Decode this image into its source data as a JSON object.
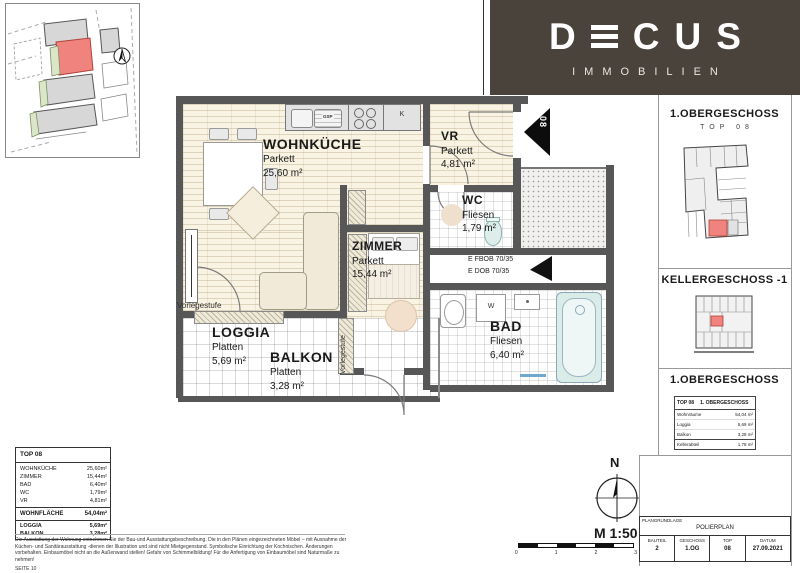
{
  "brand": {
    "name": "DECUS",
    "letters": [
      "D",
      "E",
      "C",
      "U",
      "S"
    ],
    "tagline": "IMMOBILIEN",
    "banner_color": "#49433b"
  },
  "plan": {
    "rooms": [
      {
        "name": "WOHNKÜCHE",
        "floor": "Parkett",
        "area": "25,60 m²"
      },
      {
        "name": "VR",
        "floor": "Parkett",
        "area": "4,81 m²"
      },
      {
        "name": "WC",
        "floor": "Fliesen",
        "area": "1,79 m²"
      },
      {
        "name": "ZIMMER",
        "floor": "Parkett",
        "area": "15,44 m²"
      },
      {
        "name": "BAD",
        "floor": "Fliesen",
        "area": "6,40 m²"
      },
      {
        "name": "LOGGIA",
        "floor": "Platten",
        "area": "5,69 m²"
      },
      {
        "name": "BALKON",
        "floor": "Platten",
        "area": "3,28 m²"
      }
    ],
    "annotations": {
      "step_label": "Vorlegestufe",
      "shaft_label_1": "E FBOB 70/35",
      "shaft_label_2": "E DOB 70/35",
      "unit_number": "08",
      "dishwasher": "GSP",
      "fridge": "K",
      "washer": "W"
    }
  },
  "sidebar": {
    "section1": {
      "title": "1.OBERGESCHOSS",
      "subtitle": "TOP 08"
    },
    "section2": {
      "title": "KELLERGESCHOSS -1"
    },
    "section3": {
      "title": "1.OBERGESCHOSS"
    },
    "table": {
      "header_left": "TOP 08",
      "header_right": "1. OBERGESCHOSS",
      "rows": [
        {
          "label": "Wohnräume",
          "value": "54,04 m²"
        },
        {
          "label": "Loggia",
          "value": "5,69 m²"
        },
        {
          "label": "Balkon",
          "value": "3,28 m²"
        },
        {
          "label": "Kellerabteil",
          "value": "1,78 m²"
        }
      ]
    }
  },
  "legend": {
    "title": "TOP 08",
    "rows": [
      {
        "label": "WOHNKÜCHE",
        "value": "25,60m²"
      },
      {
        "label": "ZIMMER",
        "value": "15,44m²"
      },
      {
        "label": "BAD",
        "value": "6,40m²"
      },
      {
        "label": "WC",
        "value": "1,79m²"
      },
      {
        "label": "VR",
        "value": "4,81m²"
      }
    ],
    "total": {
      "label": "WOHNFLÄCHE",
      "value": "54,04m²"
    },
    "outdoor": [
      {
        "label": "LOGGIA",
        "value": "5,69m²"
      },
      {
        "label": "BALKON",
        "value": "3,28m²"
      }
    ]
  },
  "footer": {
    "disclaimer_line1": "Die Ausstattung der Wohnung entnehmen Sie der Bau-und Ausstattungsbeschreibung. Die in den Plänen eingezeichneten Möbel – mit Ausnahme der",
    "disclaimer_line2": "Küchen- und Sanitärausstattung -dienen der Illustration und sind nicht Mietgegenstand. Symbolische Einrichtung der Kochnischen. Änderungen",
    "disclaimer_line3": "vorbehalten. Einbaumöbel nicht an die Außenwand stellen! Gefahr von Schimmelbildung! Für die Anfertigung von Einbaumöbel sind Naturmaße zu nehmen!",
    "page": "SEITE 10",
    "scale_label": "M 1:50",
    "scale_ticks": [
      "0",
      "1",
      "2",
      "3"
    ],
    "north_label": "N"
  },
  "titleblock": {
    "row1_label": "PLANGRUNDLAGE",
    "row1_value": "POLIERPLAN",
    "cells": [
      {
        "label": "BAUTEIL",
        "value": "2"
      },
      {
        "label": "GESCHOSS",
        "value": "1.OG"
      },
      {
        "label": "TOP",
        "value": "08"
      },
      {
        "label": "DATUM",
        "value": "27.09.2021"
      }
    ]
  }
}
